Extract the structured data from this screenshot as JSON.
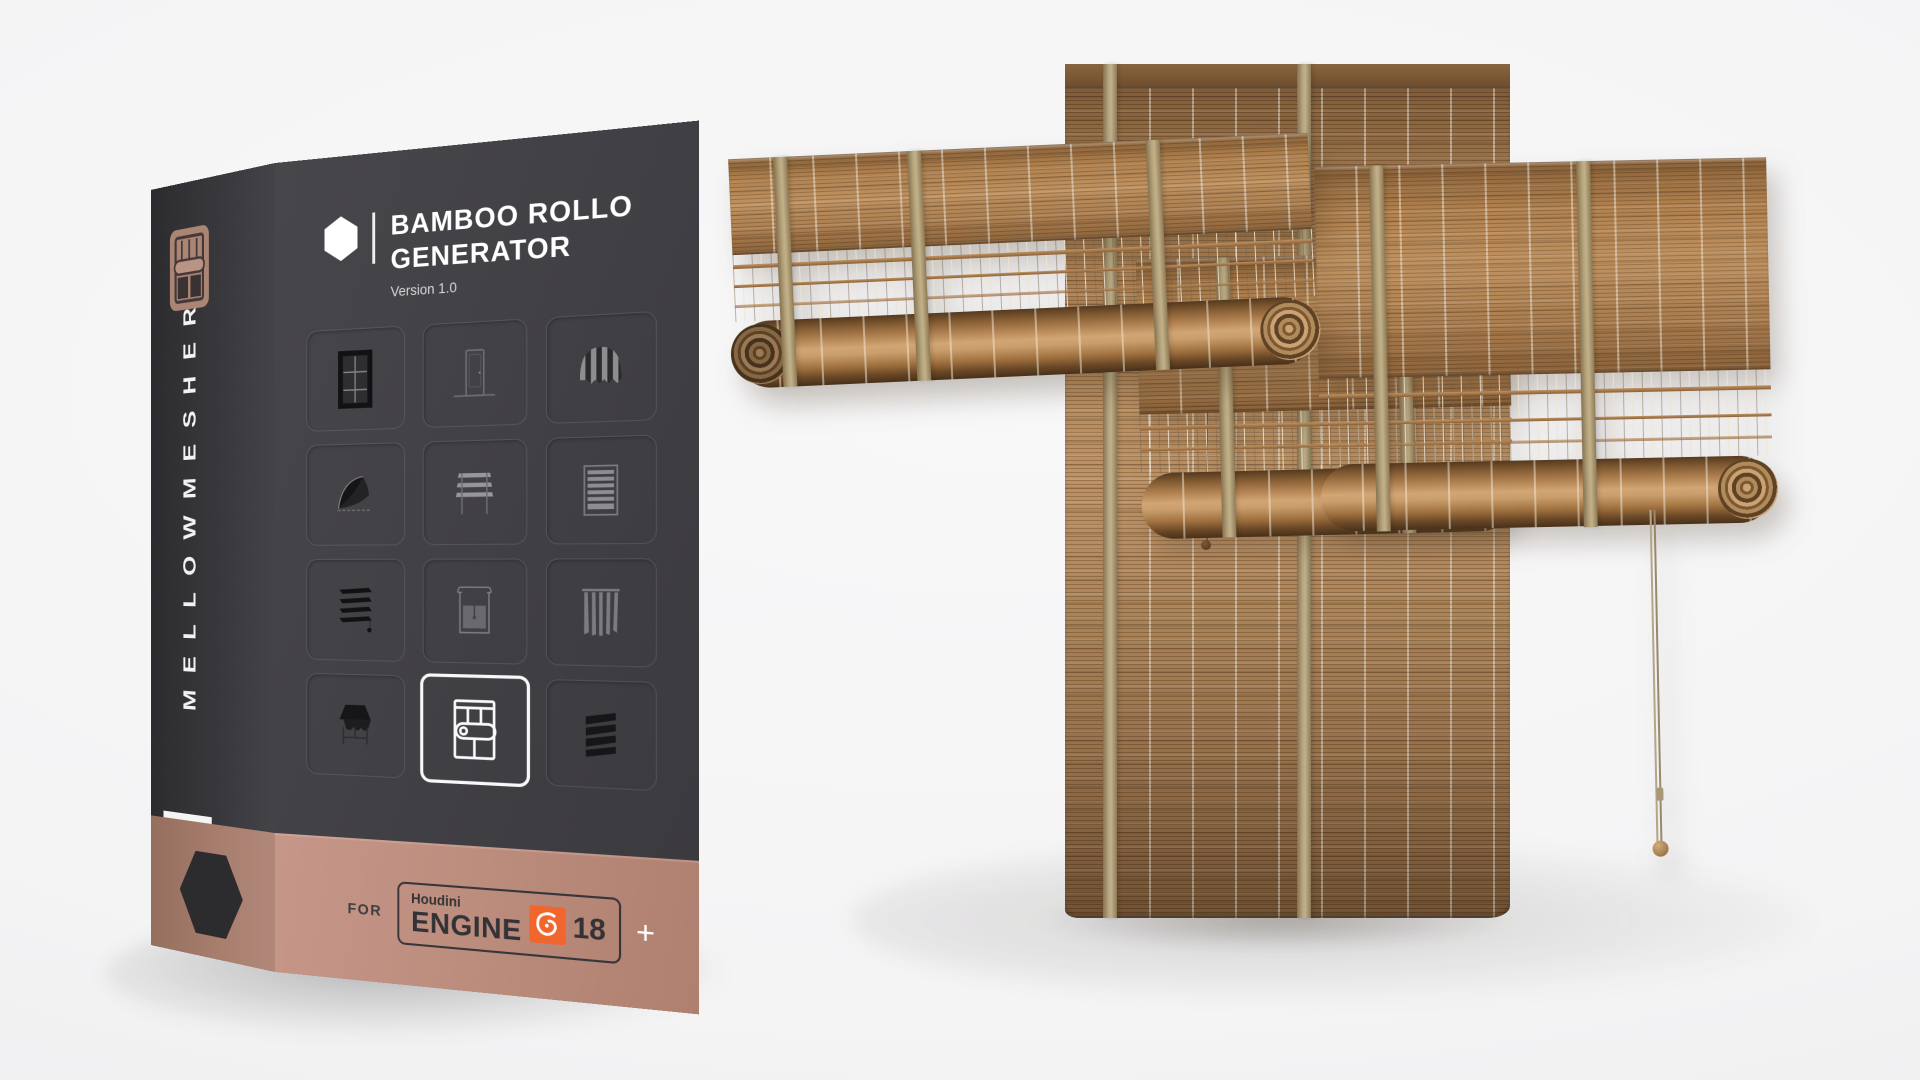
{
  "box": {
    "brand": "MELLOWMESHER",
    "title_line1": "BAMBOO ROLLO",
    "title_line2": "GENERATOR",
    "version": "Version 1.0",
    "band": {
      "for_label": "FOR",
      "houdini": "Houdini",
      "engine": "ENGINE",
      "engine_version": "18",
      "plus": "+"
    }
  },
  "icon_grid": {
    "rows": 4,
    "cols": 3,
    "icons": [
      {
        "name": "window",
        "highlighted": false
      },
      {
        "name": "door",
        "highlighted": false
      },
      {
        "name": "striped-awning",
        "highlighted": false
      },
      {
        "name": "dome-awning",
        "highlighted": false
      },
      {
        "name": "roman-shade",
        "highlighted": false
      },
      {
        "name": "venetian-blind",
        "highlighted": false
      },
      {
        "name": "slat-blinds",
        "highlighted": false
      },
      {
        "name": "roller-shade",
        "highlighted": false
      },
      {
        "name": "vertical-blinds",
        "highlighted": false
      },
      {
        "name": "storefront-awning",
        "highlighted": false
      },
      {
        "name": "bamboo-rollo",
        "highlighted": true
      },
      {
        "name": "louver-shutters",
        "highlighted": false
      }
    ]
  },
  "colors": {
    "box_dark": "#413f44",
    "spine_dark": "#38373b",
    "band_tan": "#bd8d7e",
    "spine_band_tan": "#a87e6e",
    "houdini_orange": "#f0662c",
    "bamboo": "#b08254",
    "strap": "#b5a37c",
    "background": "#f4f4f5"
  }
}
